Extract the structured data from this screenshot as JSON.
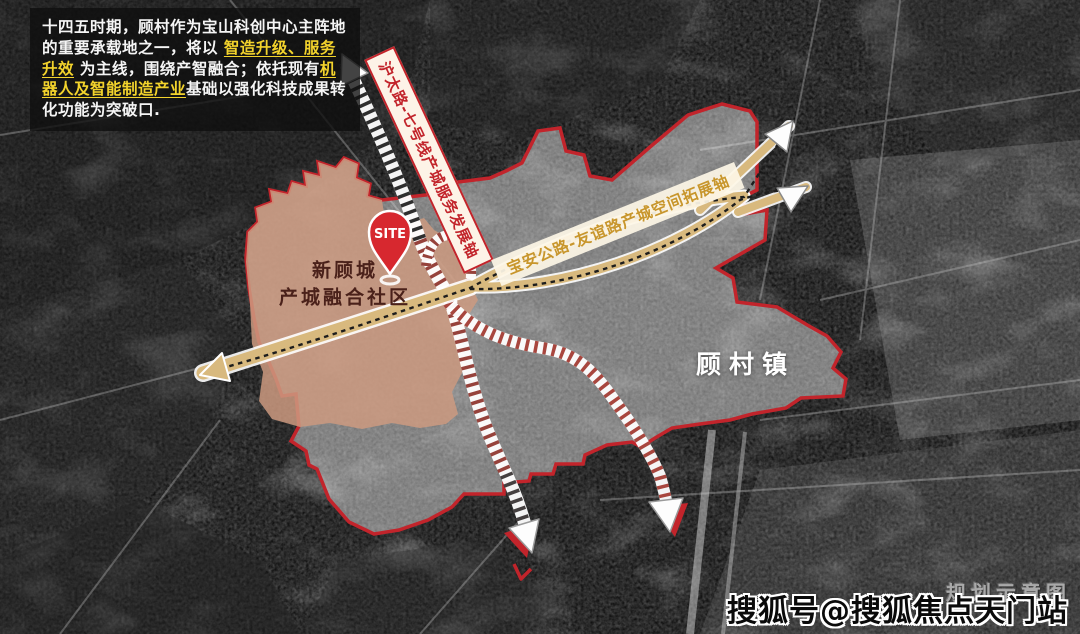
{
  "colors": {
    "boundary_red": "#c2242b",
    "core_area_fill": "#cd9a80",
    "axis_tan": "#d8b97e",
    "banner_red_text": "#c2242b",
    "banner_gold_text": "#c8962c",
    "highlight_yellow": "#f3d32c",
    "overlay_white": "rgba(255,255,255,0.42)"
  },
  "info_panel": {
    "seg1": "十四五时期，顾村作为宝山科创中心主阵地的重要承载地之一，将以 ",
    "hl1": "智造升级、服务升效",
    "seg2": " 为主线，围绕产智融合；依托现有",
    "hl2": "机器人及智能制造产业",
    "seg3": "基础以强化科技成果转化功能为突破口."
  },
  "map": {
    "site_label": "SITE",
    "core_area_name_line1": "新顾城",
    "core_area_name_line2": "产城融合社区",
    "town_label": "顾村镇",
    "axis1_label": "沪太路-七号线产城服务发展轴",
    "axis2_label": "宝安公路-友谊路产城空间拓展轴",
    "sketch_note": "规划示意图"
  },
  "watermark": {
    "text": "搜狐号@搜狐焦点天门站"
  }
}
